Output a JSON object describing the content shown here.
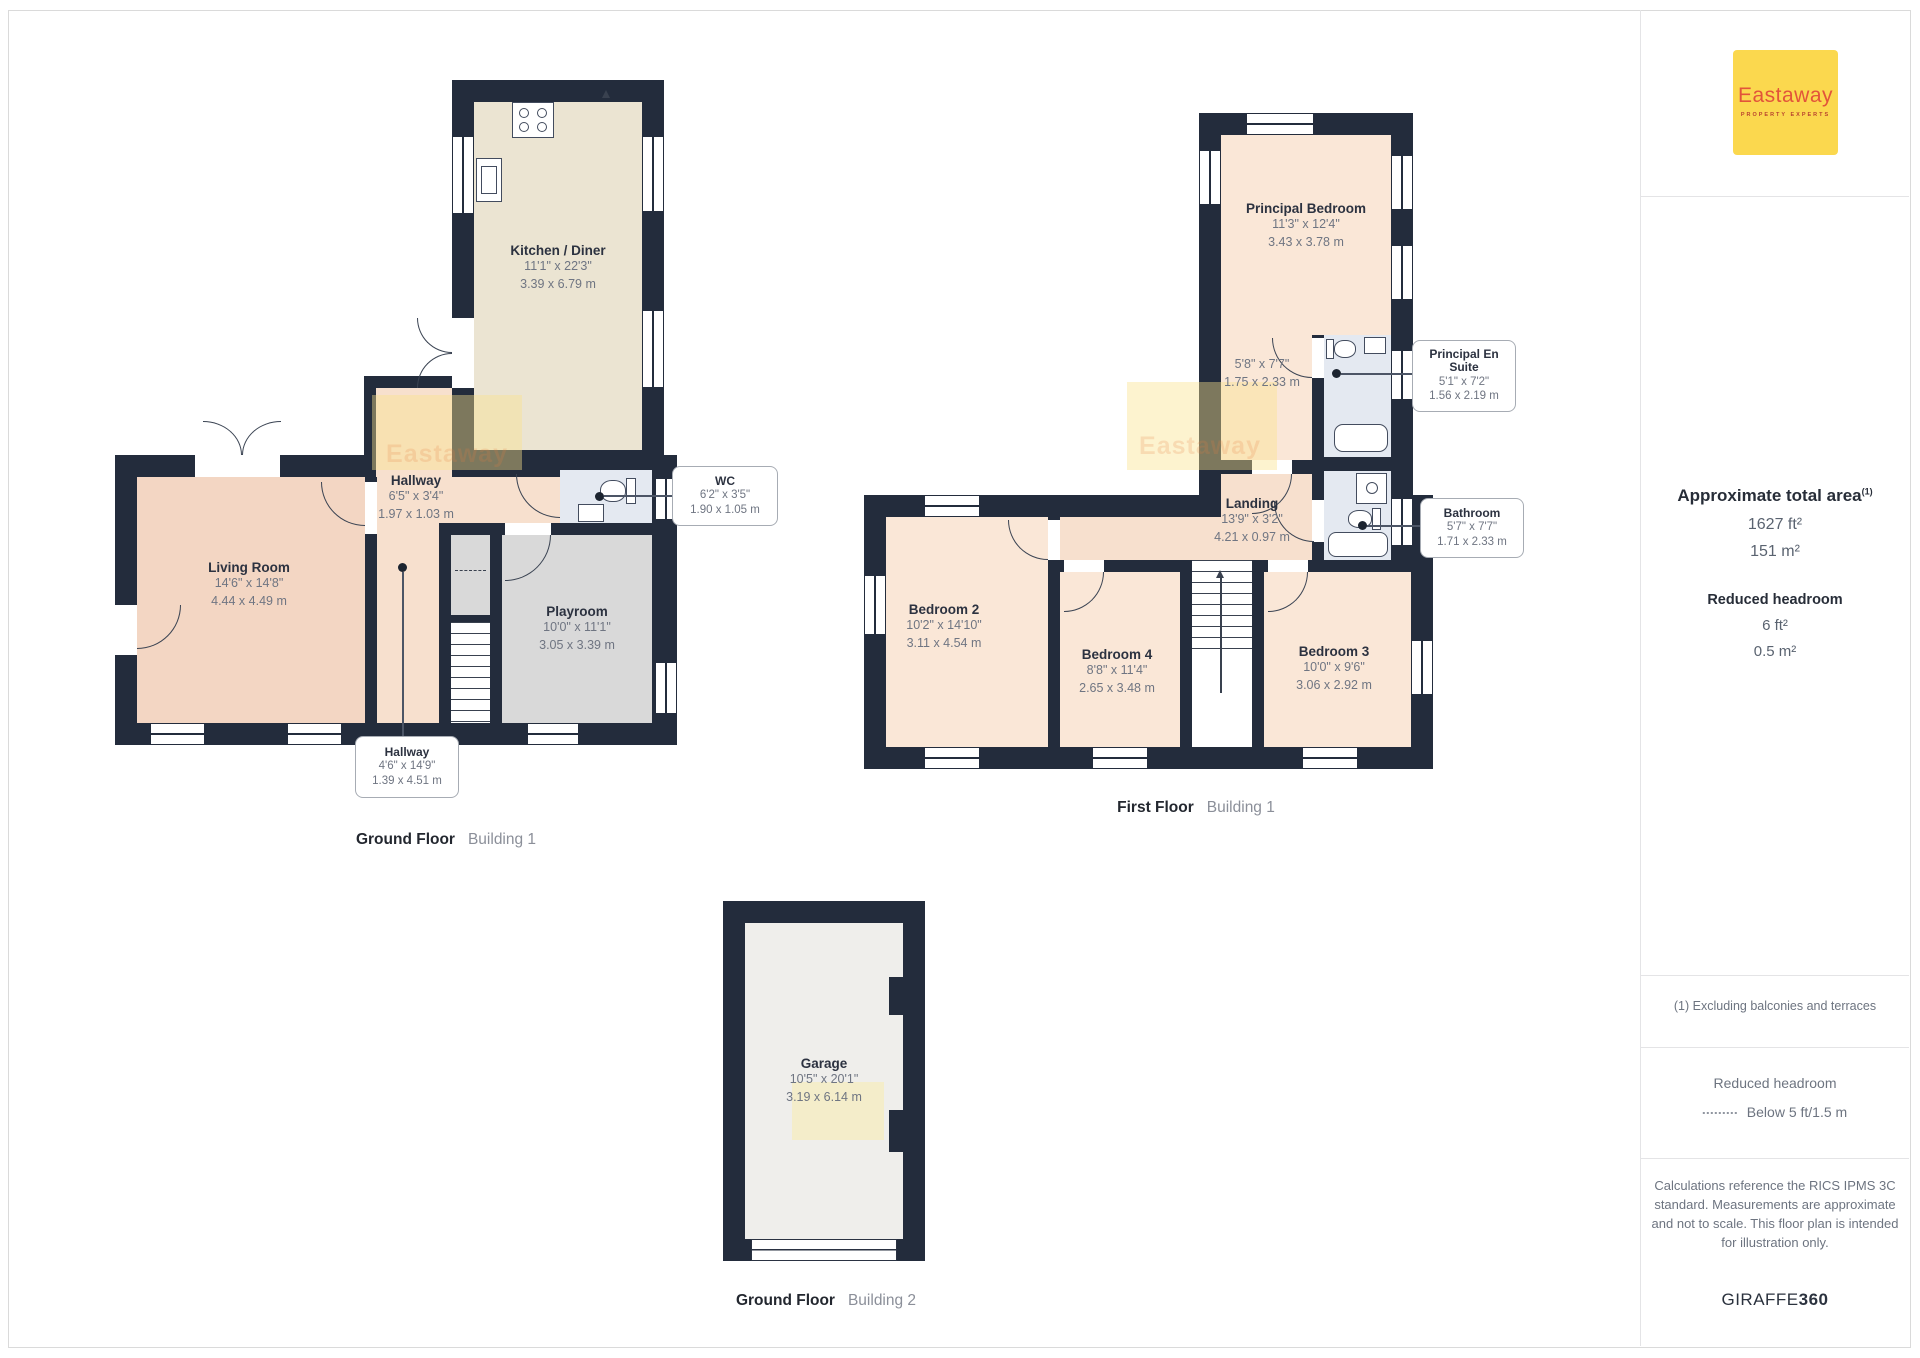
{
  "colors": {
    "wall": "#232c3c",
    "kitchen_floor": "#ebe4d2",
    "living_floor": "#f3d6c3",
    "hallway_floor": "#f7e0ce",
    "bedroom_floor": "#fae7d7",
    "playroom_floor": "#d9d9d9",
    "wet_room_floor": "#e4e9f1",
    "garage_floor": "#efeeeb",
    "logo_bg": "#fbd84e",
    "logo_text": "#e2543a"
  },
  "plans": {
    "ground_floor_b1": {
      "title": "Ground Floor",
      "subtitle": "Building 1",
      "rooms": {
        "kitchen": {
          "name": "Kitchen / Diner",
          "imperial": "11'1\" x 22'3\"",
          "metric": "3.39 x 6.79 m"
        },
        "living": {
          "name": "Living Room",
          "imperial": "14'6\" x 14'8\"",
          "metric": "4.44 x 4.49 m"
        },
        "hallway": {
          "name": "Hallway",
          "imperial": "6'5\" x 3'4\"",
          "metric": "1.97 x 1.03 m"
        },
        "playroom": {
          "name": "Playroom",
          "imperial": "10'0\" x 11'1\"",
          "metric": "3.05 x 3.39 m"
        }
      },
      "callouts": {
        "wc": {
          "name": "WC",
          "imperial": "6'2\" x 3'5\"",
          "metric": "1.90 x 1.05 m"
        },
        "hallway2": {
          "name": "Hallway",
          "imperial": "4'6\" x 14'9\"",
          "metric": "1.39 x 4.51 m"
        }
      }
    },
    "first_floor_b1": {
      "title": "First Floor",
      "subtitle": "Building 1",
      "rooms": {
        "principal_bedroom": {
          "name": "Principal Bedroom",
          "imperial": "11'3\" x 12'4\"",
          "metric": "3.43 x 3.78 m"
        },
        "principal_bedroom_sub": {
          "imperial": "5'8\" x 7'7\"",
          "metric": "1.75 x 2.33 m"
        },
        "landing": {
          "name": "Landing",
          "imperial": "13'9\" x 3'2\"",
          "metric": "4.21 x 0.97 m"
        },
        "bedroom2": {
          "name": "Bedroom 2",
          "imperial": "10'2\" x 14'10\"",
          "metric": "3.11 x 4.54 m"
        },
        "bedroom4": {
          "name": "Bedroom 4",
          "imperial": "8'8\" x 11'4\"",
          "metric": "2.65 x 3.48 m"
        },
        "bedroom3": {
          "name": "Bedroom 3",
          "imperial": "10'0\" x 9'6\"",
          "metric": "3.06 x 2.92 m"
        }
      },
      "callouts": {
        "principal_en_suite": {
          "name": "Principal En Suite",
          "imperial": "5'1\" x 7'2\"",
          "metric": "1.56 x 2.19 m"
        },
        "bathroom": {
          "name": "Bathroom",
          "imperial": "5'7\" x 7'7\"",
          "metric": "1.71 x 2.33 m"
        }
      }
    },
    "ground_floor_b2": {
      "title": "Ground Floor",
      "subtitle": "Building 2",
      "rooms": {
        "garage": {
          "name": "Garage",
          "imperial": "10'5\" x 20'1\"",
          "metric": "3.19 x 6.14 m"
        }
      }
    }
  },
  "sidebar": {
    "logo": {
      "brand": "Eastaway",
      "tagline": "PROPERTY EXPERTS"
    },
    "total_area": {
      "heading": "Approximate total area",
      "footnote_marker": "(1)",
      "imperial": "1627 ft²",
      "metric": "151 m²"
    },
    "reduced_headroom": {
      "heading": "Reduced headroom",
      "imperial": "6 ft²",
      "metric": "0.5 m²"
    },
    "footnote": "(1) Excluding balconies and terraces",
    "legend": {
      "title": "Reduced headroom",
      "item": "Below 5 ft/1.5 m"
    },
    "disclaimer": "Calculations reference the RICS IPMS 3C standard. Measurements are approximate and not to scale. This floor plan is intended for illustration only.",
    "brand_footer": {
      "name": "GIRAFFE",
      "suffix": "360"
    }
  },
  "watermark": {
    "text": "Eastaway"
  }
}
